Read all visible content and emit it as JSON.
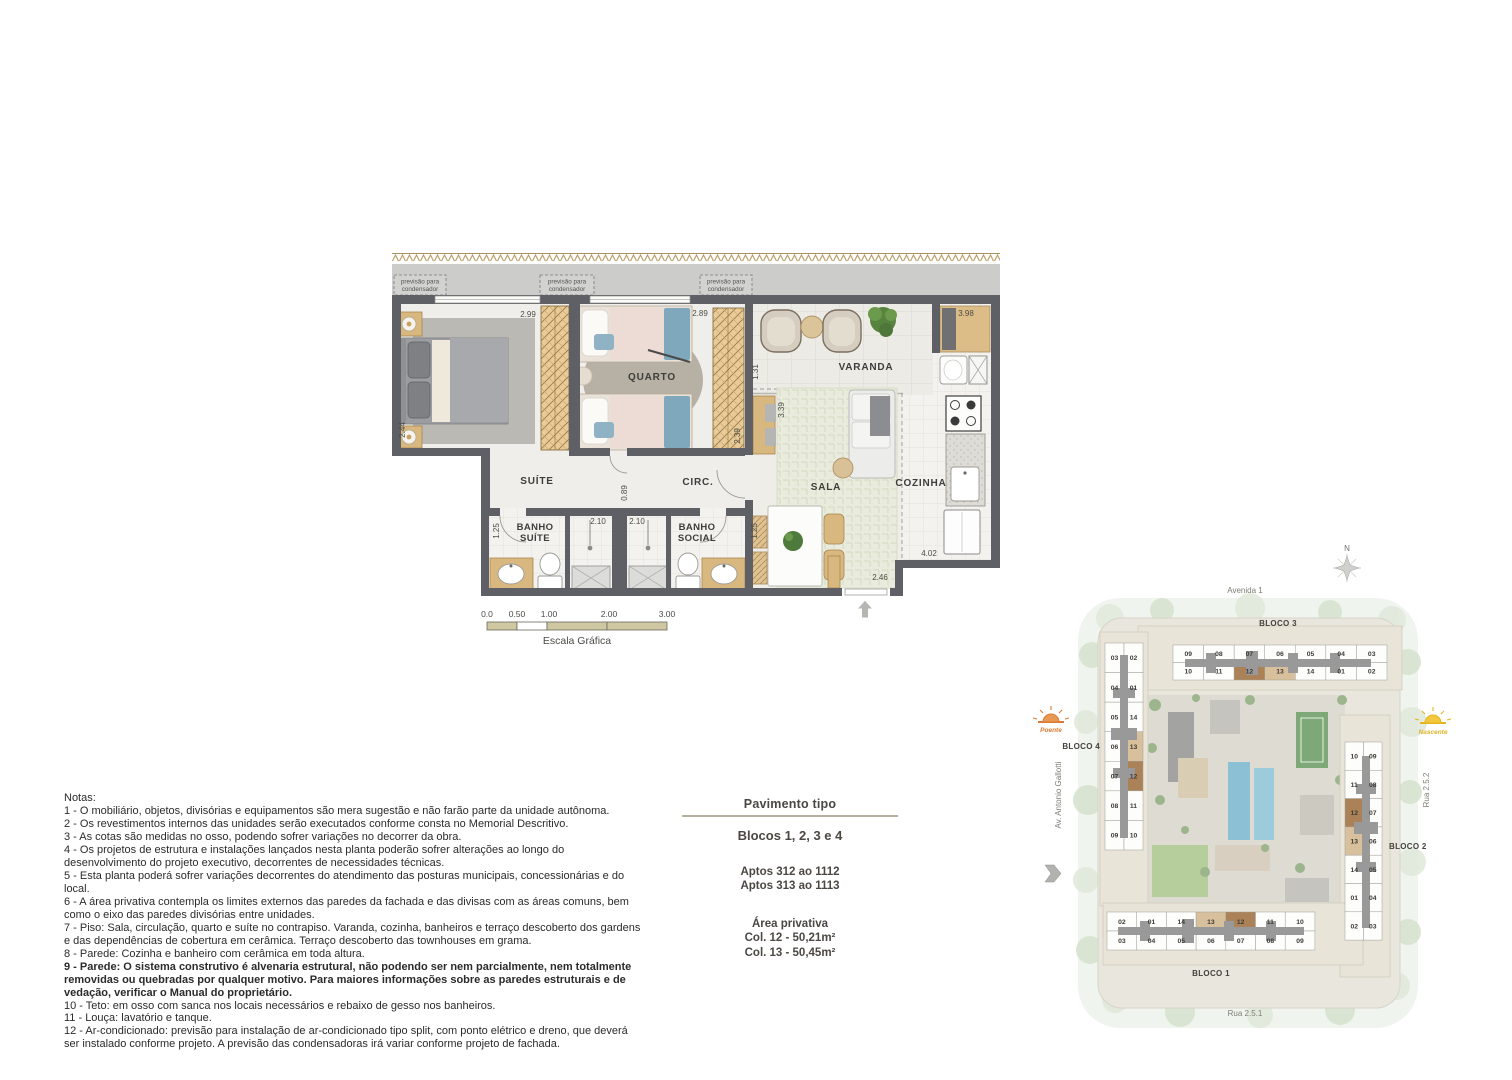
{
  "floor_plan": {
    "rooms": {
      "suite": "SUÍTE",
      "quarto": "QUARTO",
      "varanda": "VARANDA",
      "sala": "SALA",
      "cozinha": "COZINHA",
      "circ": "CIRC.",
      "banho_suite_l1": "BANHO",
      "banho_suite_l2": "SUÍTE",
      "banho_social_l1": "BANHO",
      "banho_social_l2": "SOCIAL"
    },
    "condenser_label_l1": "previsão para",
    "condenser_label_l2": "condensador",
    "dims": {
      "suite_top": "2.99",
      "quarto_top": "2.89",
      "cozinha_top": "3.98",
      "suite_left": "2.44",
      "varanda_left": "1.31",
      "sala_left": "3.39",
      "quarto_right": "2.39",
      "circ": "0.89",
      "banho_suite_shower": "2.10",
      "banho_social_shower": "2.10",
      "banho_suite_width": "1.25",
      "banho_social_width": "1.25",
      "cozinha_bottom": "4.02",
      "sala_bottom": "2.46"
    }
  },
  "scale_bar": {
    "ticks": [
      "0.0",
      "0.50",
      "1.00",
      "2.00",
      "3.00"
    ],
    "label": "Escala Gráfica"
  },
  "notes": {
    "title": "Notas:",
    "items": [
      {
        "text": "1 - O mobiliário, objetos, divisórias e equipamentos são mera sugestão e não farão parte da unidade autônoma.",
        "bold": false
      },
      {
        "text": "2 - Os revestimentos internos das unidades serão executados conforme consta no Memorial Descritivo.",
        "bold": false
      },
      {
        "text": "3 - As cotas são medidas no osso, podendo sofrer variações no decorrer da obra.",
        "bold": false
      },
      {
        "text": "4 - Os projetos de estrutura e instalações lançados nesta planta poderão sofrer alterações ao longo do desenvolvimento do projeto executivo, decorrentes de necessidades técnicas.",
        "bold": false
      },
      {
        "text": "5 - Esta planta poderá sofrer variações decorrentes do atendimento das posturas municipais, concessionárias e do local.",
        "bold": false
      },
      {
        "text": "6 - A área privativa contempla os limites externos das paredes da fachada e das divisas com as áreas comuns, bem como o eixo das paredes divisórias entre unidades.",
        "bold": false
      },
      {
        "text": "7 - Piso: Sala, circulação, quarto e suíte no contrapiso. Varanda, cozinha, banheiros e terraço descoberto dos gardens e das dependências de cobertura em cerâmica. Terraço descoberto das townhouses em grama.",
        "bold": false
      },
      {
        "text": "8 - Parede: Cozinha e banheiro com cerâmica em toda altura.",
        "bold": false
      },
      {
        "text": "9 - Parede: O sistema construtivo é alvenaria estrutural, não podendo ser nem parcialmente, nem totalmente removidas ou quebradas por qualquer motivo. Para maiores informações sobre as paredes estruturais e de vedação, verificar o Manual do proprietário.",
        "bold": true
      },
      {
        "text": "10 - Teto: em osso com sanca nos locais necessários e rebaixo de gesso nos banheiros.",
        "bold": false
      },
      {
        "text": "11 - Louça: lavatório e tanque.",
        "bold": false
      },
      {
        "text": "12 - Ar-condicionado: previsão para instalação de ar-condicionado tipo split, com ponto elétrico e dreno, que deverá ser instalado conforme projeto. A previsão das condensadoras irá variar conforme projeto de fachada.",
        "bold": false
      }
    ]
  },
  "info_panel": {
    "title": "Pavimento tipo",
    "blocks_line": "Blocos 1, 2, 3 e 4",
    "aptos": [
      "Aptos 312 ao 1112",
      "Aptos 313 ao 1113"
    ],
    "area_title": "Área privativa",
    "areas": [
      "Col. 12 - 50,21m²",
      "Col. 13 - 50,45m²"
    ]
  },
  "site_plan": {
    "compass": "N",
    "streets": {
      "top": "Avenida 1",
      "bottom": "Rua 2.5.1",
      "right": "Rua 2.5.2",
      "left": "Av. Antonio Gallotti"
    },
    "sun_west": "Poente",
    "sun_east": "Nascente",
    "highlight_units": {
      "dark": "12",
      "light": "13"
    },
    "colors": {
      "unit_12": "#ab8257",
      "unit_13": "#d9c09c"
    },
    "blocks": [
      {
        "name": "BLOCO 3",
        "rows": [
          [
            "09",
            "08",
            "07",
            "06",
            "05",
            "04",
            "03"
          ],
          [
            "10",
            "11",
            "12",
            "13",
            "14",
            "01",
            "02"
          ]
        ]
      },
      {
        "name": "BLOCO 4",
        "cols": [
          [
            "03",
            "04",
            "05",
            "06",
            "07",
            "08",
            "09"
          ],
          [
            "02",
            "01",
            "14",
            "13",
            "12",
            "11",
            "10"
          ]
        ]
      },
      {
        "name": "BLOCO 2",
        "cols": [
          [
            "10",
            "11",
            "12",
            "13",
            "14",
            "01",
            "02"
          ],
          [
            "09",
            "08",
            "07",
            "06",
            "05",
            "04",
            "03"
          ]
        ]
      },
      {
        "name": "BLOCO 1",
        "rows": [
          [
            "02",
            "01",
            "14",
            "13",
            "12",
            "11",
            "10"
          ],
          [
            "03",
            "04",
            "05",
            "06",
            "07",
            "08",
            "09"
          ]
        ]
      }
    ]
  }
}
